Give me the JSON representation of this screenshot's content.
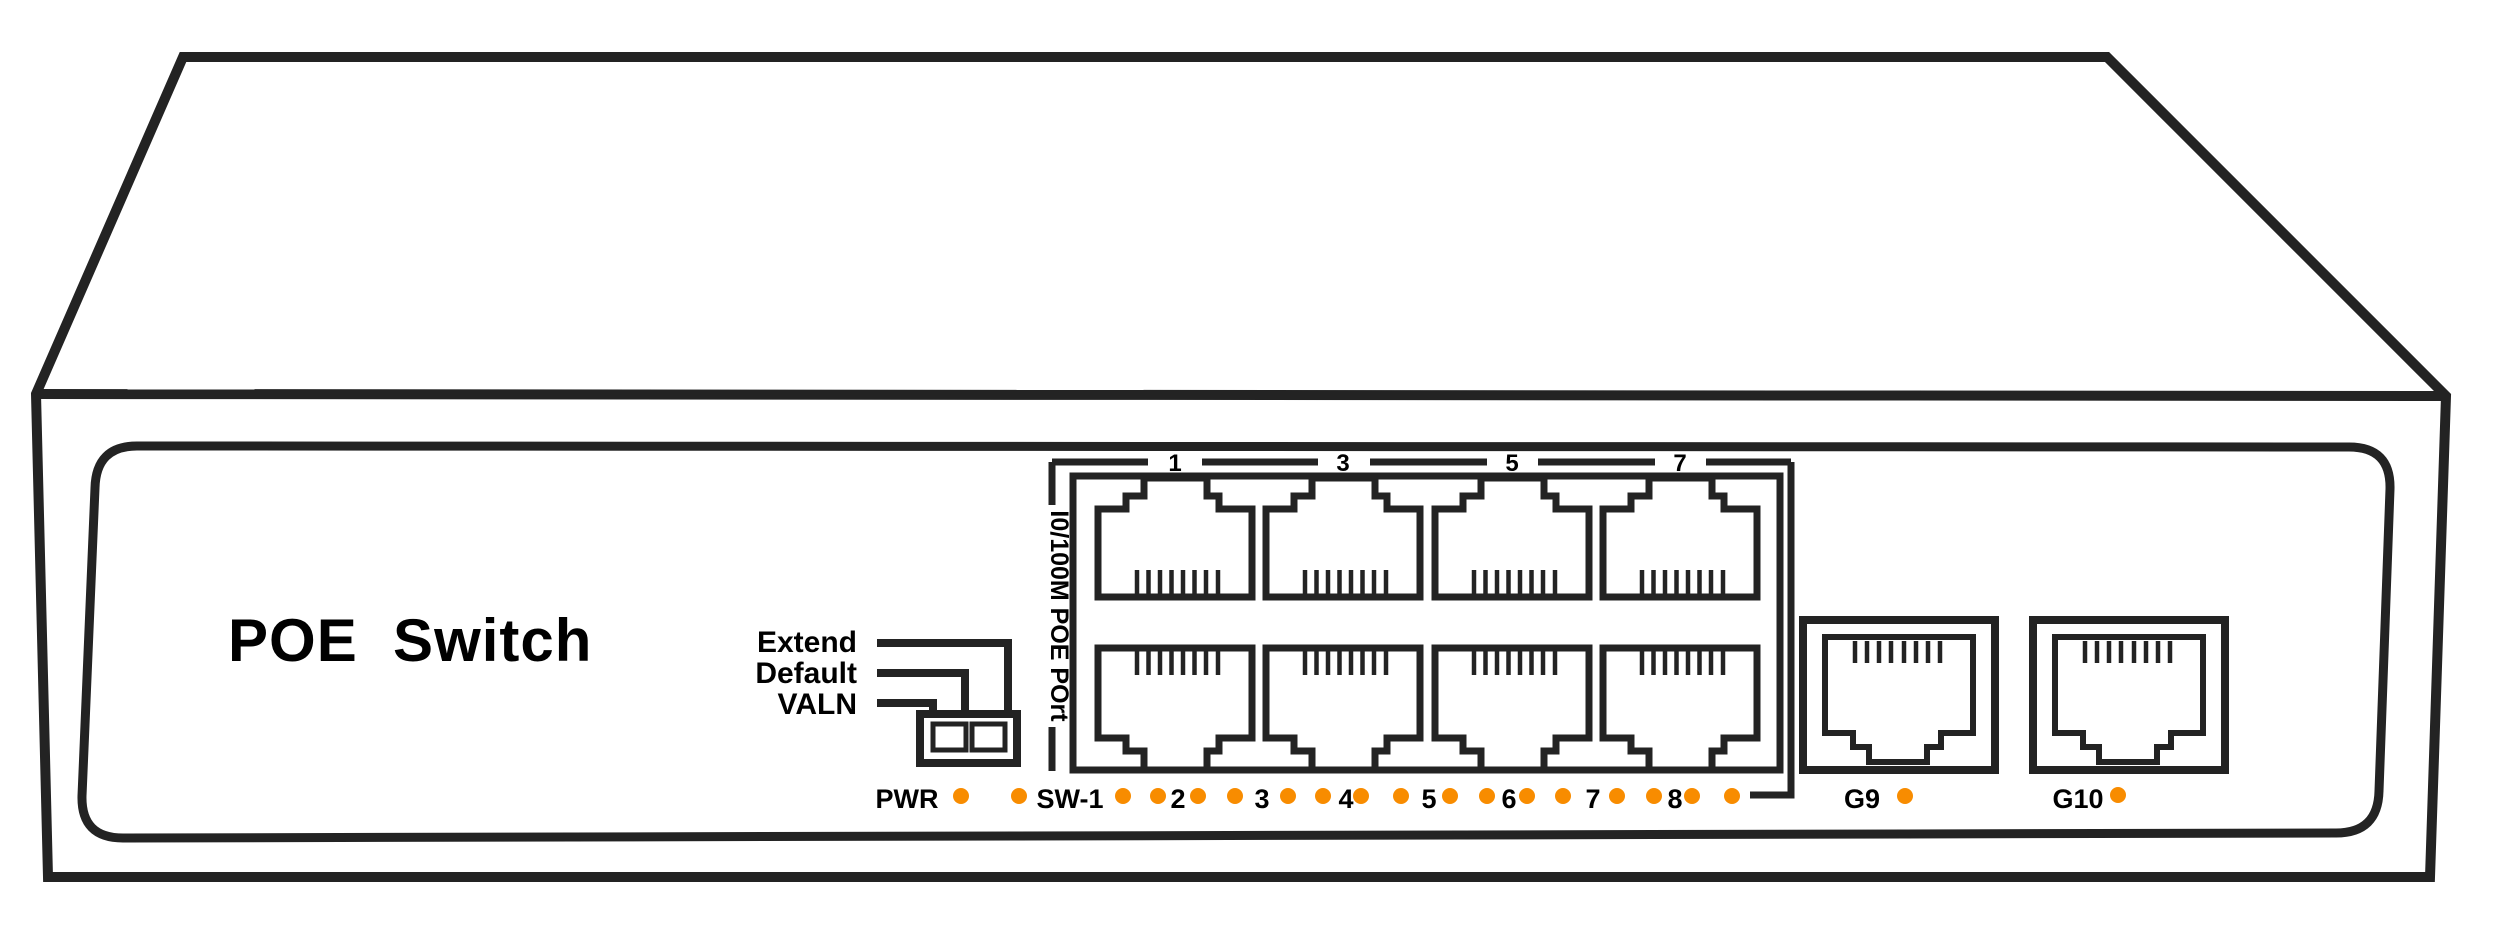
{
  "diagram_title": "POE Switch front panel diagram",
  "colors": {
    "line": "#232323",
    "led": "#f88c00",
    "bg": "#ffffff",
    "text": "#000000"
  },
  "panel": {
    "brand_label": "POE  Switch"
  },
  "dip_switch": {
    "labels": [
      "Extend",
      "Default",
      "VALN"
    ],
    "positions": 2
  },
  "poe_ports": {
    "group_label": "I0/100M POE POrt",
    "top_row_numbers": [
      "1",
      "3",
      "5",
      "7"
    ],
    "port_count": 8
  },
  "led_row": {
    "labels": [
      "PWR",
      "SW-1",
      "2",
      "3",
      "4",
      "5",
      "6",
      "7",
      "8"
    ],
    "panel_led_count": 18,
    "led_color": "#f88c00"
  },
  "uplink_ports": {
    "labels": [
      "G9",
      "G10"
    ],
    "port_count": 2
  }
}
